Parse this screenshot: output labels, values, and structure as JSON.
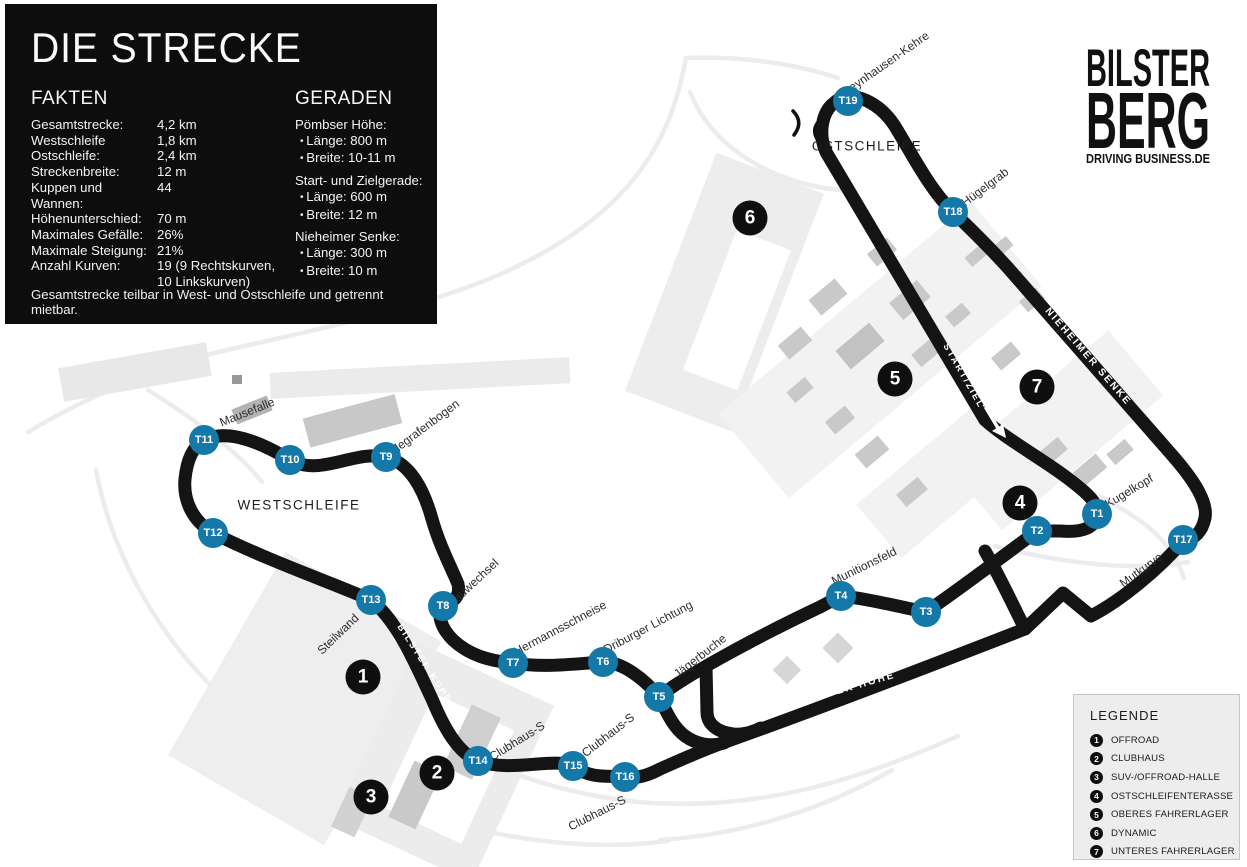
{
  "info_box": {
    "title": "DIE STRECKE",
    "facts": {
      "heading": "FAKTEN",
      "rows": [
        {
          "label": "Gesamtstrecke:",
          "value": "4,2 km"
        },
        {
          "label": "Westschleife",
          "value": "1,8 km"
        },
        {
          "label": "Ostschleife:",
          "value": "2,4 km"
        },
        {
          "label": "Streckenbreite:",
          "value": "12 m"
        },
        {
          "label": "Kuppen und Wannen:",
          "value": "44"
        },
        {
          "label": "Höhenunterschied:",
          "value": "70 m"
        },
        {
          "label": "Maximales Gefälle:",
          "value": "26%"
        },
        {
          "label": "Maximale Steigung:",
          "value": "21%"
        },
        {
          "label": "Anzahl Kurven:",
          "value": "19 (9 Rechtskurven, 10 Linkskurven)"
        }
      ]
    },
    "straights": {
      "heading": "GERADEN",
      "groups": [
        {
          "name": "Pömbser Höhe:",
          "items": [
            "Länge: 800 m",
            "Breite: 10-11 m"
          ]
        },
        {
          "name": "Start- und Zielgerade:",
          "items": [
            "Länge: 600 m",
            "Breite: 12 m"
          ]
        },
        {
          "name": "Nieheimer Senke:",
          "items": [
            "Länge: 300 m",
            "Breite: 10 m"
          ]
        }
      ]
    },
    "footnote": "Gesamtstrecke teilbar in West- und Ostschleife und getrennt mietbar."
  },
  "logo": {
    "line1": "BILSTER",
    "line2": "BERG",
    "tagline": "DRIVING BUSINESS.DE"
  },
  "legend": {
    "heading": "LEGENDE",
    "items": [
      {
        "num": "1",
        "label": "OFFROAD"
      },
      {
        "num": "2",
        "label": "CLUBHAUS"
      },
      {
        "num": "3",
        "label": "SUV-/OFFROAD-HALLE"
      },
      {
        "num": "4",
        "label": "OSTSCHLEIFENTERASSE"
      },
      {
        "num": "5",
        "label": "OBERES FAHRERLAGER"
      },
      {
        "num": "6",
        "label": "DYNAMIC"
      },
      {
        "num": "7",
        "label": "UNTERES FAHRERLAGER"
      }
    ]
  },
  "map": {
    "section_labels": {
      "west": "WESTSCHLEIFE",
      "east": "OSTSCHLEIFE"
    },
    "track_labels": {
      "bilster_kuppe": "BILSTER KUPPE",
      "start_ziel": "START/ZIEL",
      "nieheimer_senke": "NIEHEIMER SENKE",
      "poembser_hoehe": "PÖMBSER HÖHE"
    },
    "turns": [
      {
        "id": "T1"
      },
      {
        "id": "T2"
      },
      {
        "id": "T3"
      },
      {
        "id": "T4"
      },
      {
        "id": "T5"
      },
      {
        "id": "T6"
      },
      {
        "id": "T7"
      },
      {
        "id": "T8"
      },
      {
        "id": "T9"
      },
      {
        "id": "T10"
      },
      {
        "id": "T11"
      },
      {
        "id": "T12"
      },
      {
        "id": "T13"
      },
      {
        "id": "T14"
      },
      {
        "id": "T15"
      },
      {
        "id": "T16"
      },
      {
        "id": "T17"
      },
      {
        "id": "T18"
      },
      {
        "id": "T19"
      }
    ],
    "corners": [
      {
        "text": "Mausefalle"
      },
      {
        "text": "Telegrafenbogen"
      },
      {
        "text": "Sauwechsel"
      },
      {
        "text": "Hermannsschneise"
      },
      {
        "text": "Driburger Lichtung"
      },
      {
        "text": "Jägerbuche"
      },
      {
        "text": "Steilwand"
      },
      {
        "text": "Clubhaus-S"
      },
      {
        "text": "Clubhaus-S"
      },
      {
        "text": "Clubhaus-S"
      },
      {
        "text": "Munitionsfeld"
      },
      {
        "text": "Mutkurve"
      },
      {
        "text": "Kugelkopf"
      },
      {
        "text": "Hügelgrab"
      },
      {
        "text": "Oeynhausen-Kehre"
      }
    ],
    "facilities": [
      {
        "num": "1"
      },
      {
        "num": "2"
      },
      {
        "num": "3"
      },
      {
        "num": "4"
      },
      {
        "num": "5"
      },
      {
        "num": "6"
      },
      {
        "num": "7"
      }
    ]
  },
  "colors": {
    "track": "#141414",
    "turn_marker": "#1478a8",
    "info_box_bg": "#0d0d0d",
    "legend_bg": "#ededed"
  }
}
